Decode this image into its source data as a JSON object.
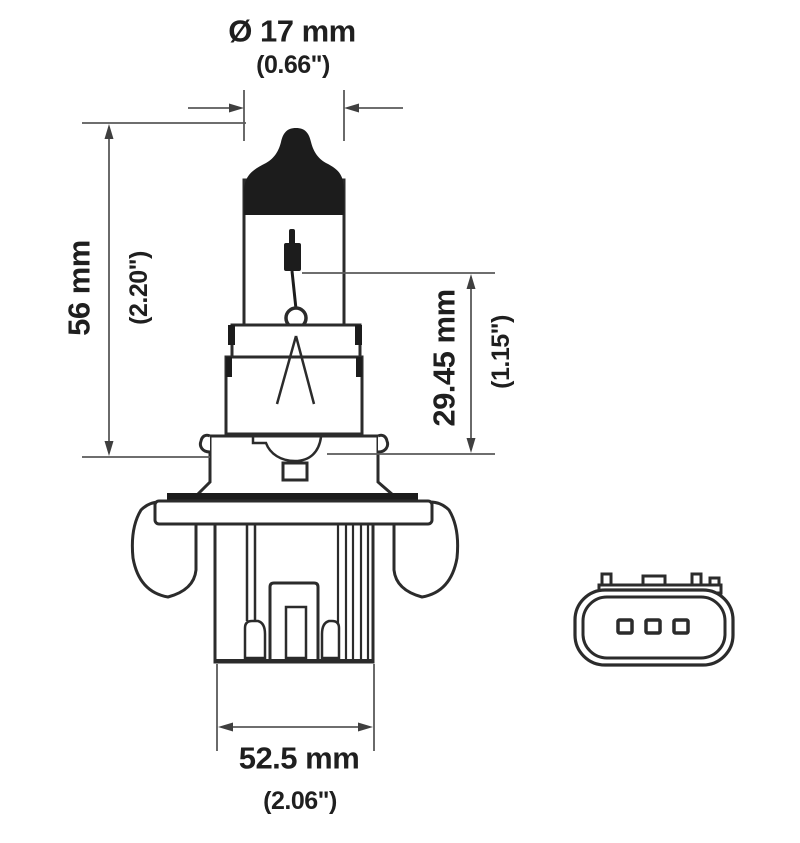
{
  "diagram": {
    "title": "Halogen bulb technical drawing with connector front view",
    "colors": {
      "background": "#ffffff",
      "outline": "#2b2b2b",
      "solid_fill": "#1c1c1c",
      "dimension_line": "#5a5a5a",
      "text": "#1f1f1f"
    },
    "dimensions": {
      "diameter": {
        "mm": "Ø 17 mm",
        "inch": "(0.66\")"
      },
      "overall_length": {
        "mm": "56 mm",
        "inch": "(2.20\")"
      },
      "glass_length": {
        "mm": "29.45 mm",
        "inch": "(1.15\")"
      },
      "base_width": {
        "mm": "52.5 mm",
        "inch": "(2.06\")"
      }
    }
  }
}
